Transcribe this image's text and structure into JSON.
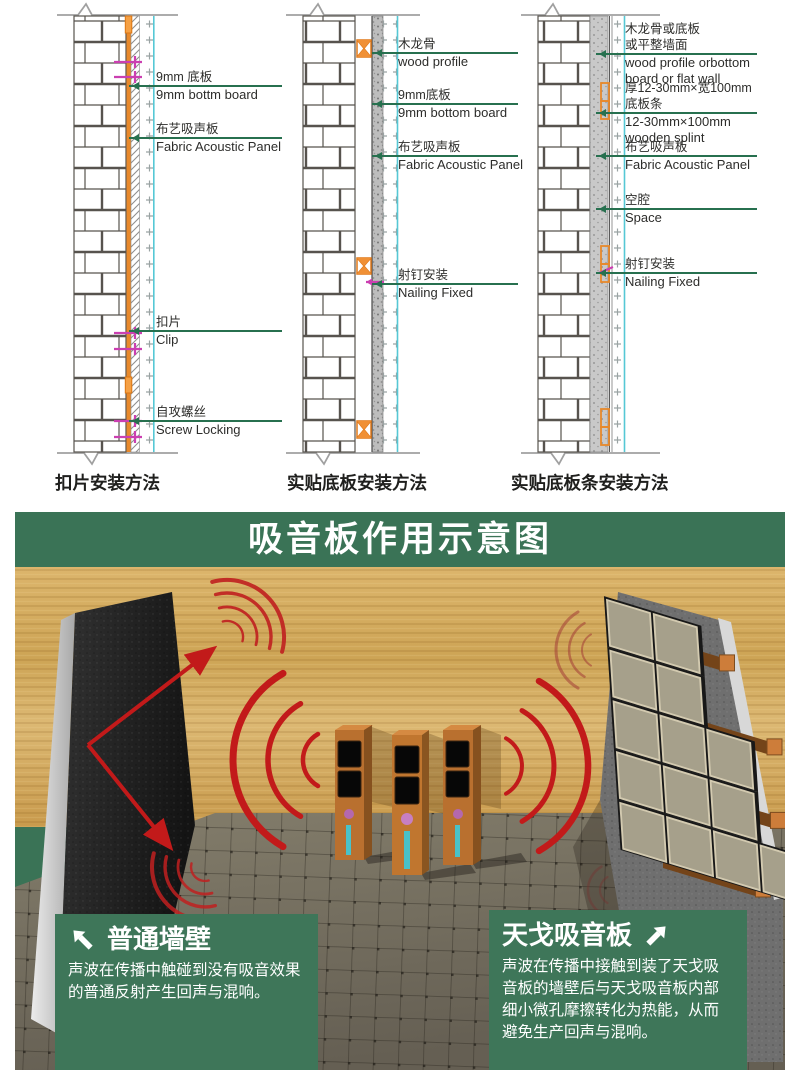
{
  "colors": {
    "band_green": "#3a7356",
    "box_green": "#3e7659",
    "pointer_green": "#27704f",
    "sound_red": "#c21a1a",
    "panel_cyan": "#55c8d5",
    "board_orange": "#e8892b",
    "clip_magenta": "#cb3fb1",
    "wood": "#d3a95c",
    "floor": "#77725f"
  },
  "diagrams": {
    "captions": [
      "扣片安装方法",
      "实贴底板安装方法",
      "实贴底板条安装方法"
    ],
    "clip_method": {
      "labels": [
        {
          "zh": "9mm 底板",
          "en": "9mm bottm board"
        },
        {
          "zh": "布艺吸声板",
          "en": "Fabric Acoustic Panel"
        },
        {
          "zh": "扣片",
          "en": "Clip"
        },
        {
          "zh": "自攻螺丝",
          "en": "Screw Locking"
        }
      ]
    },
    "glued_board_method": {
      "labels": [
        {
          "zh": "木龙骨",
          "en": "wood profile"
        },
        {
          "zh": "9mm底板",
          "en": "9mm bottom board"
        },
        {
          "zh": "布艺吸声板",
          "en": "Fabric Acoustic Panel"
        },
        {
          "zh": "射钉安装",
          "en": "Nailing Fixed"
        }
      ]
    },
    "glued_batten_method": {
      "labels": [
        {
          "zh": "木龙骨或底板\n或平整墙面",
          "en": "wood profile orbottom\nboard or flat wall"
        },
        {
          "zh": "厚12-30mm×宽100mm\n底板条",
          "en": "12-30mm×100mm\nwooden splint"
        },
        {
          "zh": "布艺吸声板",
          "en": "Fabric Acoustic Panel"
        },
        {
          "zh": "空腔",
          "en": "Space"
        },
        {
          "zh": "射钉安装",
          "en": "Nailing Fixed"
        }
      ]
    }
  },
  "illustration": {
    "title": "吸音板作用示意图",
    "plain_wall_box": {
      "title": "普通墙壁",
      "body": "声波在传播中触碰到没有吸音效果的普通反射产生回声与混响。"
    },
    "acoustic_panel_box": {
      "title": "天戈吸音板",
      "body": "声波在传播中接触到装了天戈吸音板的墙壁后与天戈吸音板内部细小微孔摩擦转化为热能，从而避免生产回声与混响。"
    }
  }
}
